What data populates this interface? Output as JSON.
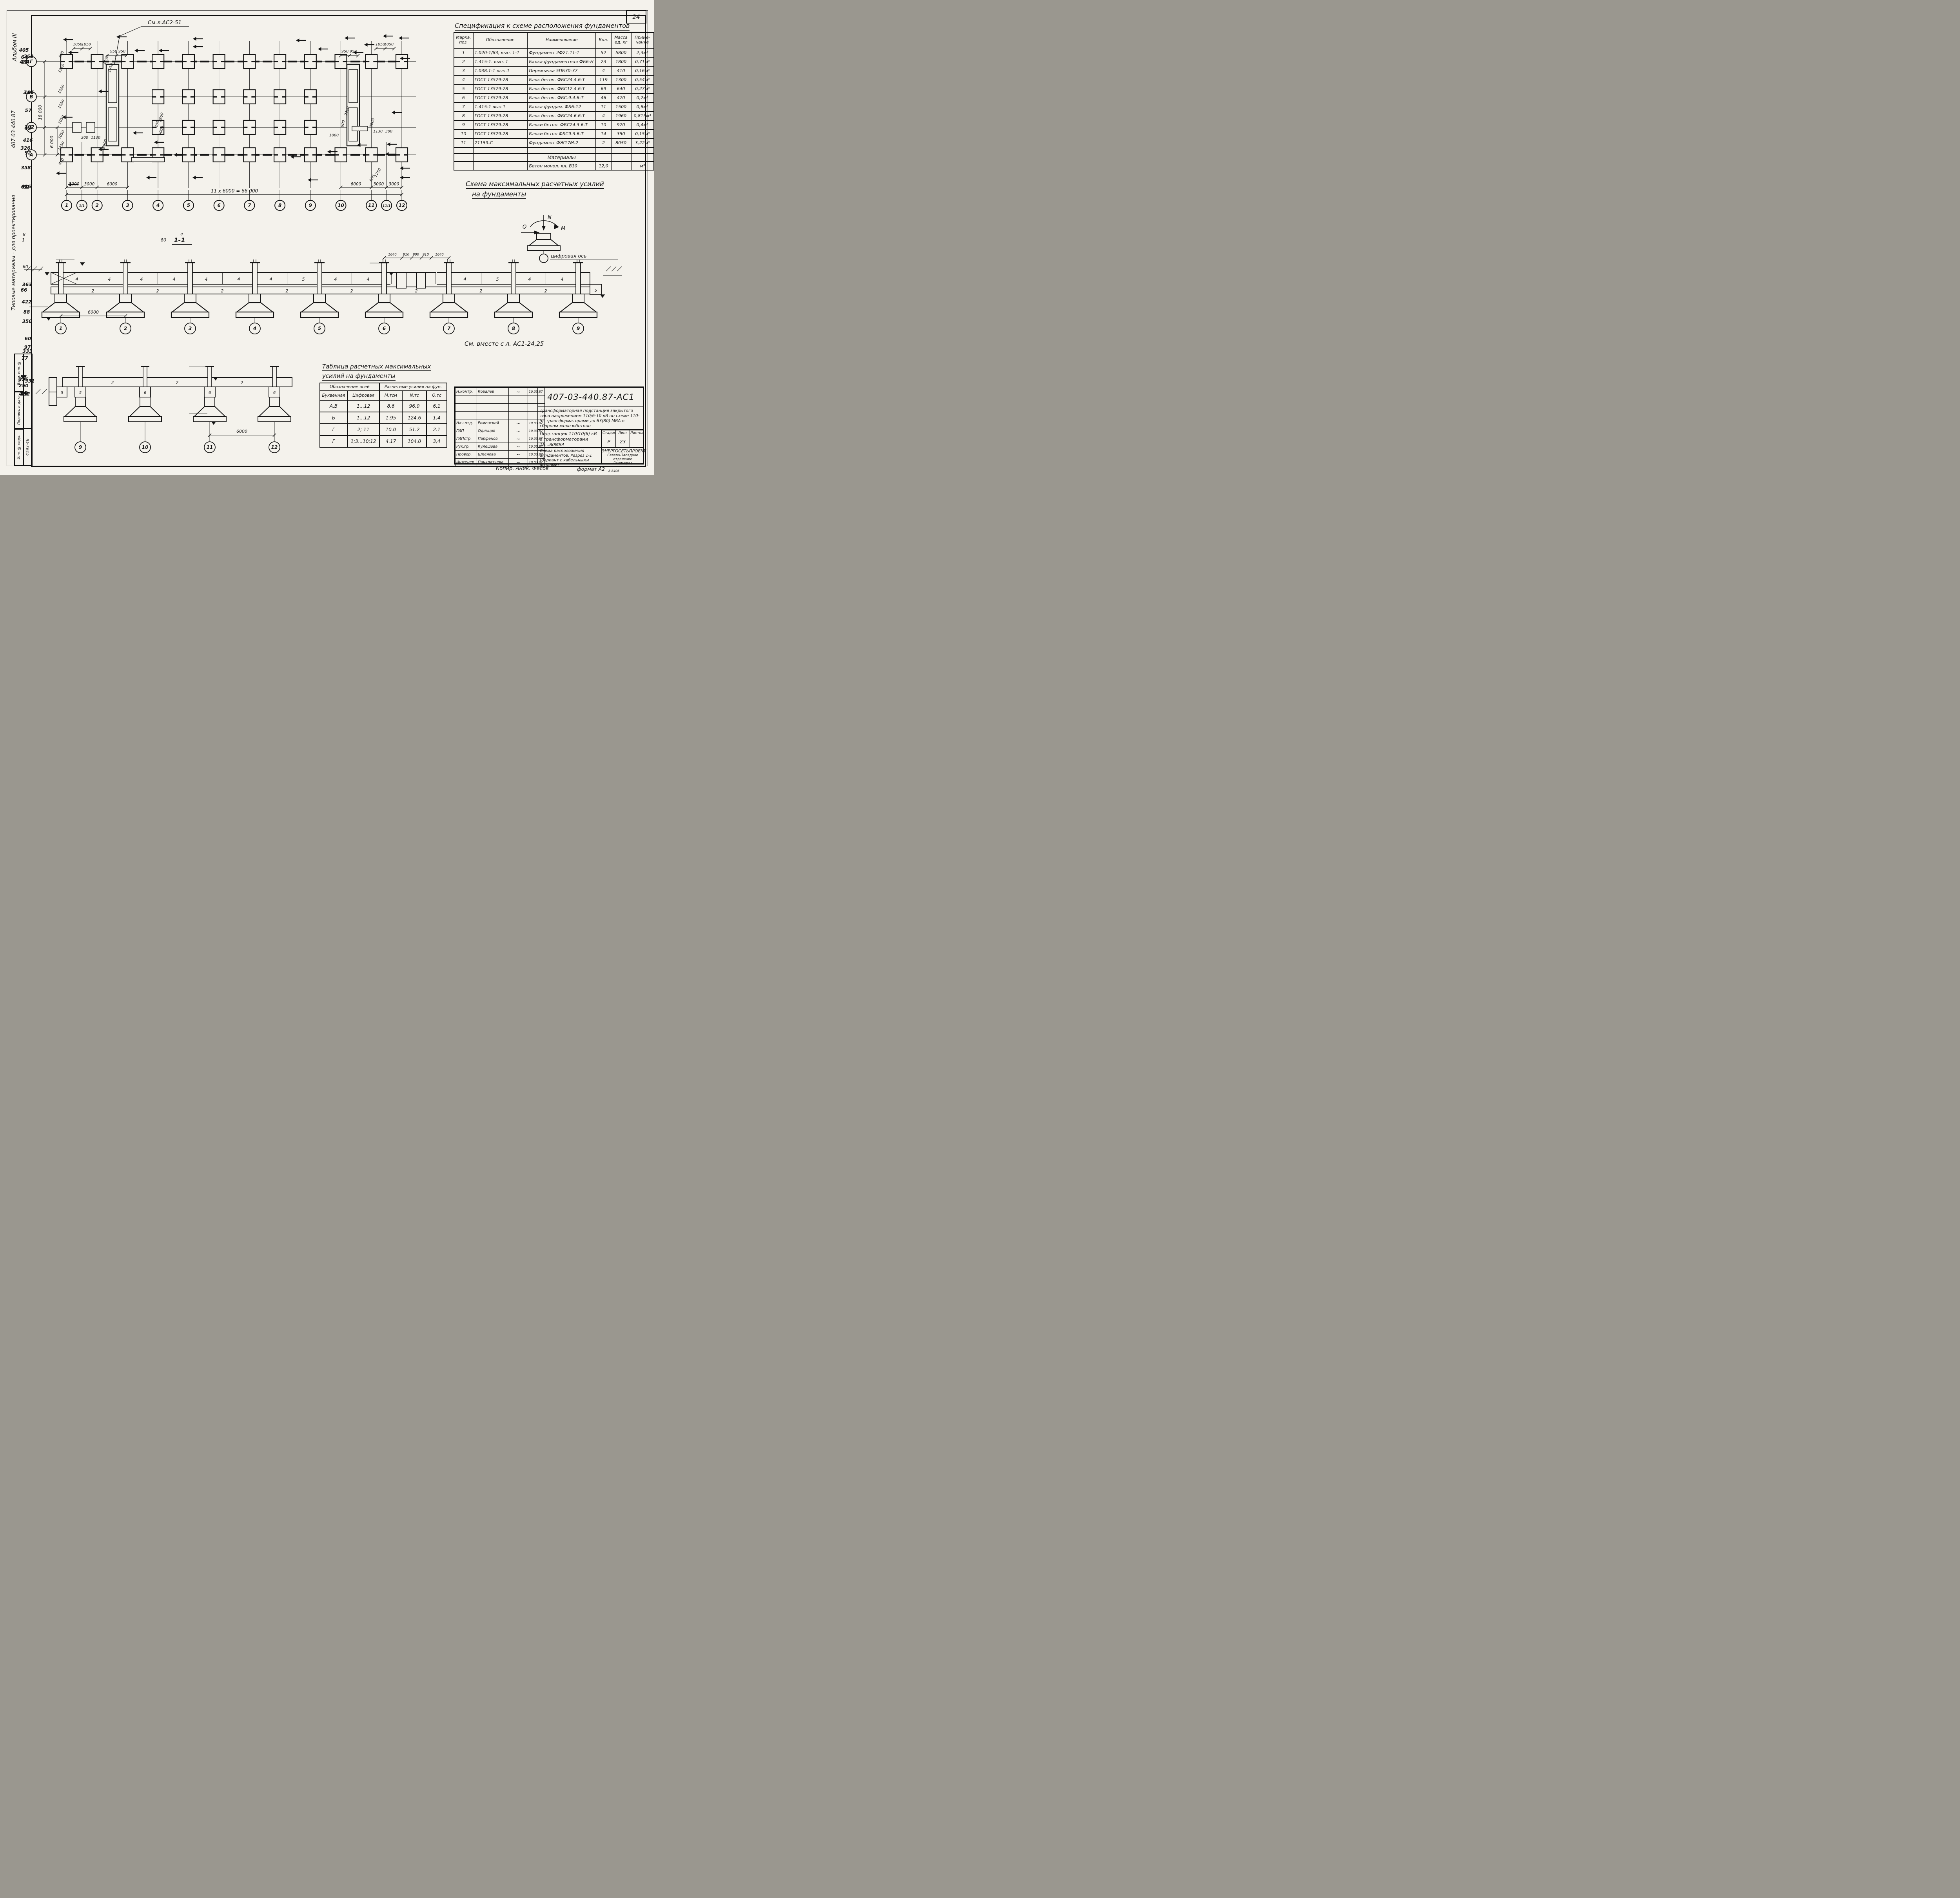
{
  "page": {
    "sheet_number": "24",
    "format_note": "формат А2",
    "copier_note": "Копир. Аник. Фесов",
    "print_code": "8 8406"
  },
  "margin": {
    "album": "Альбом III",
    "series": "Типовые материалы - для проектирования",
    "series_number": "407-03-440.87",
    "stamp_fields": [
      "Взам. инв. №",
      "Подпись и дата",
      "Инв. № подл."
    ],
    "inv_value": "4193-46"
  },
  "plan": {
    "note": "См.л.АС2-51",
    "row_axes": [
      "Г",
      "В",
      "Б",
      "А"
    ],
    "col_labels": [
      "1",
      "1/1",
      "2",
      "3",
      "4",
      "5",
      "6",
      "7",
      "8",
      "9",
      "10",
      "11",
      "11/1",
      "12"
    ],
    "col_mm": [
      0,
      3000,
      6000,
      12000,
      18000,
      24000,
      30000,
      36000,
      42000,
      48000,
      54000,
      60000,
      63000,
      66000
    ],
    "dims": {
      "top_left": [
        "1050",
        "1050"
      ],
      "top_mid": [
        "950",
        "950"
      ],
      "top_right": [
        "1050",
        "1050"
      ],
      "top_mid_right": [
        "950",
        "950"
      ],
      "left": [
        "850",
        "1250",
        "1050",
        "1050",
        "1050",
        "1050",
        "1250",
        "850"
      ],
      "left_total": "18 000",
      "left_span": "6 000",
      "bottom_left": [
        "3000",
        "3000",
        "6000"
      ],
      "bottom_right": [
        "6000",
        "3000",
        "3000"
      ],
      "total": "11 х 6000 = 66 000"
    },
    "flags": [
      [
        "2",
        118,
        64
      ],
      [
        "3",
        131,
        97
      ],
      [
        "12",
        254,
        57
      ],
      [
        "11",
        300,
        92
      ],
      [
        "11",
        362,
        92
      ],
      [
        "2",
        449,
        62
      ],
      [
        "7",
        449,
        82
      ],
      [
        "1",
        712,
        66
      ],
      [
        "8",
        768,
        88
      ],
      [
        "11",
        836,
        60
      ],
      [
        "10",
        858,
        97
      ],
      [
        "3",
        886,
        77
      ],
      [
        "по 12",
        934,
        55
      ],
      [
        "2",
        974,
        60
      ],
      [
        "4",
        977,
        112
      ],
      [
        "14",
        208,
        196
      ],
      [
        "13",
        116,
        262
      ],
      [
        "12",
        208,
        344
      ],
      [
        "15",
        296,
        302
      ],
      [
        "5",
        350,
        326
      ],
      [
        "6",
        400,
        358
      ],
      [
        "11",
        330,
        416
      ],
      [
        "7",
        448,
        416
      ],
      [
        "9",
        698,
        363
      ],
      [
        "9",
        792,
        350
      ],
      [
        "8",
        742,
        422
      ],
      [
        "10",
        868,
        333
      ],
      [
        "16",
        944,
        331
      ],
      [
        "по 12",
        940,
        356
      ],
      [
        "по 13",
        956,
        250
      ],
      [
        "1",
        100,
        405
      ],
      [
        "3",
        130,
        434
      ],
      [
        "4",
        977,
        392
      ],
      [
        "1",
        977,
        416
      ]
    ],
    "labels": [
      [
        "1050",
        138,
        84,
        0
      ],
      [
        "1050",
        160,
        84,
        0
      ],
      [
        "950",
        230,
        102,
        0
      ],
      [
        "950",
        251,
        102,
        0
      ],
      [
        "1150",
        213,
        122,
        -70
      ],
      [
        "1350",
        225,
        142,
        -70
      ],
      [
        "950",
        820,
        102,
        0
      ],
      [
        "950",
        841,
        102,
        0
      ],
      [
        "1050",
        910,
        84,
        0
      ],
      [
        "1050",
        932,
        84,
        0
      ],
      [
        "850",
        99,
        108,
        -60
      ],
      [
        "1250",
        99,
        144,
        -60
      ],
      [
        "1050",
        99,
        197,
        -60
      ],
      [
        "1050",
        99,
        235,
        -60
      ],
      [
        "1050",
        99,
        275,
        -60
      ],
      [
        "1050",
        99,
        313,
        -60
      ],
      [
        "1250",
        99,
        342,
        -60
      ],
      [
        "850",
        99,
        382,
        -60
      ],
      [
        "300",
        156,
        322,
        0
      ],
      [
        "1130",
        184,
        322,
        0
      ],
      [
        "3900",
        210,
        336,
        -75
      ],
      [
        "400",
        344,
        286,
        -75
      ],
      [
        "2600",
        354,
        268,
        -75
      ],
      [
        "3000",
        354,
        302,
        -75
      ],
      [
        "2400",
        828,
        252,
        -75
      ],
      [
        "900",
        818,
        284,
        -75
      ],
      [
        "1000",
        792,
        316,
        0
      ],
      [
        "1130",
        904,
        306,
        0
      ],
      [
        "300",
        932,
        306,
        0
      ],
      [
        "3900",
        892,
        282,
        -75
      ],
      [
        "1250",
        906,
        410,
        -60
      ],
      [
        "850",
        892,
        424,
        -60
      ]
    ]
  },
  "section11": {
    "title": "1-1",
    "axes": [
      "1",
      "2",
      "3",
      "4",
      "5",
      "6",
      "7",
      "8",
      "9"
    ],
    "span_dim": "6000",
    "pit_dims": [
      "1640",
      "910",
      "900",
      "910",
      "1640"
    ],
    "elev_cap": "-2.130",
    "elev_ground": "-2,400",
    "elev_base": "-4,350",
    "elev_pit": "-2,550",
    "elev_end": "-3,300",
    "beam_labels": [
      "2",
      "2",
      "2",
      "2",
      "2",
      "2",
      "2",
      "2"
    ],
    "block_labels": [
      "4",
      "4",
      "4",
      "4",
      "4",
      "4",
      "4",
      "5",
      "4",
      "4",
      "",
      "",
      "4",
      "5",
      "4",
      "4"
    ],
    "end_block": "5"
  },
  "force_scheme": {
    "title1": "Схема максимальных расчетных усилий",
    "title2": "на фундаменты",
    "n": "N",
    "m": "M",
    "q": "Q",
    "axis_note": "цифровая ось"
  },
  "see_note": "См. вместе с л. АС1-24,25",
  "section_small": {
    "axes": [
      "9",
      "10",
      "11",
      "12"
    ],
    "elev_top": "-2.130",
    "elev_base": "-4,350",
    "span_dim": "6000",
    "beam_label": "2",
    "wall_label": "5",
    "block_labels": [
      "5",
      "6",
      "6",
      "6"
    ]
  },
  "spec_table": {
    "title": "Спецификация к схеме расположения фундаментов",
    "headers": [
      "Марка, поз.",
      "Обозначение",
      "Наименование",
      "Кол.",
      "Масса ед. кг",
      "Приме- чание"
    ],
    "rows": [
      [
        "1",
        "1.020-1/83, вып. 1-1",
        "Фундамент 2Ф21.11-1",
        "52",
        "5800",
        "2,3м³"
      ],
      [
        "2",
        "1.415-1. вып. 1",
        "Балка фундаментная ФБ6-Н",
        "23",
        "1800",
        "0,71м³"
      ],
      [
        "3",
        "1.038.1-1 вып.1",
        "Перемычка 5ПБ30-37",
        "4",
        "410",
        "0,16м³"
      ],
      [
        "4",
        "ГОСТ 13579-78",
        "Блок бетон. ФБС24.4.6-Т",
        "119",
        "1300",
        "0,54м³"
      ],
      [
        "5",
        "ГОСТ 13579-78",
        "Блок бетон. ФБС12.4.6-Т",
        "69",
        "640",
        "0,27м³"
      ],
      [
        "6",
        "ГОСТ 13579-78",
        "Блок бетон. ФБС.9.4.6-Т",
        "46",
        "470",
        "0,2м³"
      ],
      [
        "7",
        "1.415-1 вып.1",
        "Балка фундам. ФБ6-12",
        "11",
        "1500",
        "0,6м³"
      ],
      [
        "8",
        "ГОСТ 13579-78",
        "Блок бетон. ФБС24.6.6-Т",
        "4",
        "1960",
        "0,815м³"
      ],
      [
        "9",
        "ГОСТ 13579-78",
        "Блоки бетон. ФБС24.3.6-Т",
        "10",
        "970",
        "0,4м³"
      ],
      [
        "10",
        "ГОСТ 13579-78",
        "Блоки бетон ФБС9.3.6-Т",
        "14",
        "350",
        "0,15м³"
      ],
      [
        "11",
        "71159-С",
        "Фундамент ФЖ17М-2",
        "2",
        "8050",
        "3,22м³"
      ]
    ],
    "materials_title": "Материалы",
    "materials_row": [
      "",
      "",
      "Бетон монол. кл. В10",
      "12,0",
      "",
      "м³"
    ]
  },
  "force_table": {
    "title1": "Таблица расчетных максимальных",
    "title2": "усилий на фундаменты",
    "group_headers": [
      "Обозначение осей",
      "Расчетные усилия на фун."
    ],
    "col_headers": [
      "Буквенная",
      "Цифровая",
      "М,тсм",
      "N,тс",
      "Q,тс"
    ],
    "rows": [
      [
        "А,В",
        "1...12",
        "8.6",
        "96.0",
        "6.1"
      ],
      [
        "Б",
        "1...12",
        "1.95",
        "124.6",
        "1.4"
      ],
      [
        "Г",
        "2; 11",
        "10.0",
        "51.2",
        "2.1"
      ],
      [
        "Г",
        "1;3...10;12",
        "4.17",
        "104.0",
        "3,4"
      ]
    ]
  },
  "title_block": {
    "doc_number": "407-03-440.87-АС1",
    "sig_rows": [
      {
        "role": "Н.контр.",
        "name": "Ковалев",
        "date": "10.03.87"
      },
      {
        "role": "",
        "name": "",
        "date": ""
      },
      {
        "role": "",
        "name": "",
        "date": ""
      },
      {
        "role": "",
        "name": "",
        "date": ""
      },
      {
        "role": "Нач.отд.",
        "name": "Роменский",
        "date": "10.03.87"
      },
      {
        "role": "ГИП",
        "name": "Одинцов",
        "date": "10.03.87"
      },
      {
        "role": "ГИПстр.",
        "name": "Парфенов",
        "date": "10.03.87"
      },
      {
        "role": "Рук.гр.",
        "name": "Кулешова",
        "date": "10.03.87"
      },
      {
        "role": "Провер.",
        "name": "Шпенова",
        "date": "10.03.87"
      },
      {
        "role": "Инженер",
        "name": "Панкратьева",
        "date": "10.03.87"
      }
    ],
    "description": "Трансформаторная подстанция закрытого типа напряжением 110/6-10 кВ по схеме 110-5с трансформаторами до 63(80) МВА в сборном железобетоне",
    "product": "Подстанция 110/10(6) кВ с трансформаторами 16...80МВА",
    "stage_headers": [
      "Стадия",
      "Лист",
      "Листов"
    ],
    "stage_values": [
      "Р",
      "23",
      ""
    ],
    "sheet_title": "Схема расположения фундаментов. Разрез 1-1 (Вариант с кабельными вводами)",
    "org_name": "ЭНЕРГОСЕТЬПРОЕКТ",
    "org_branch": "Северо-Западное отделение",
    "org_city": "Ленинград"
  }
}
